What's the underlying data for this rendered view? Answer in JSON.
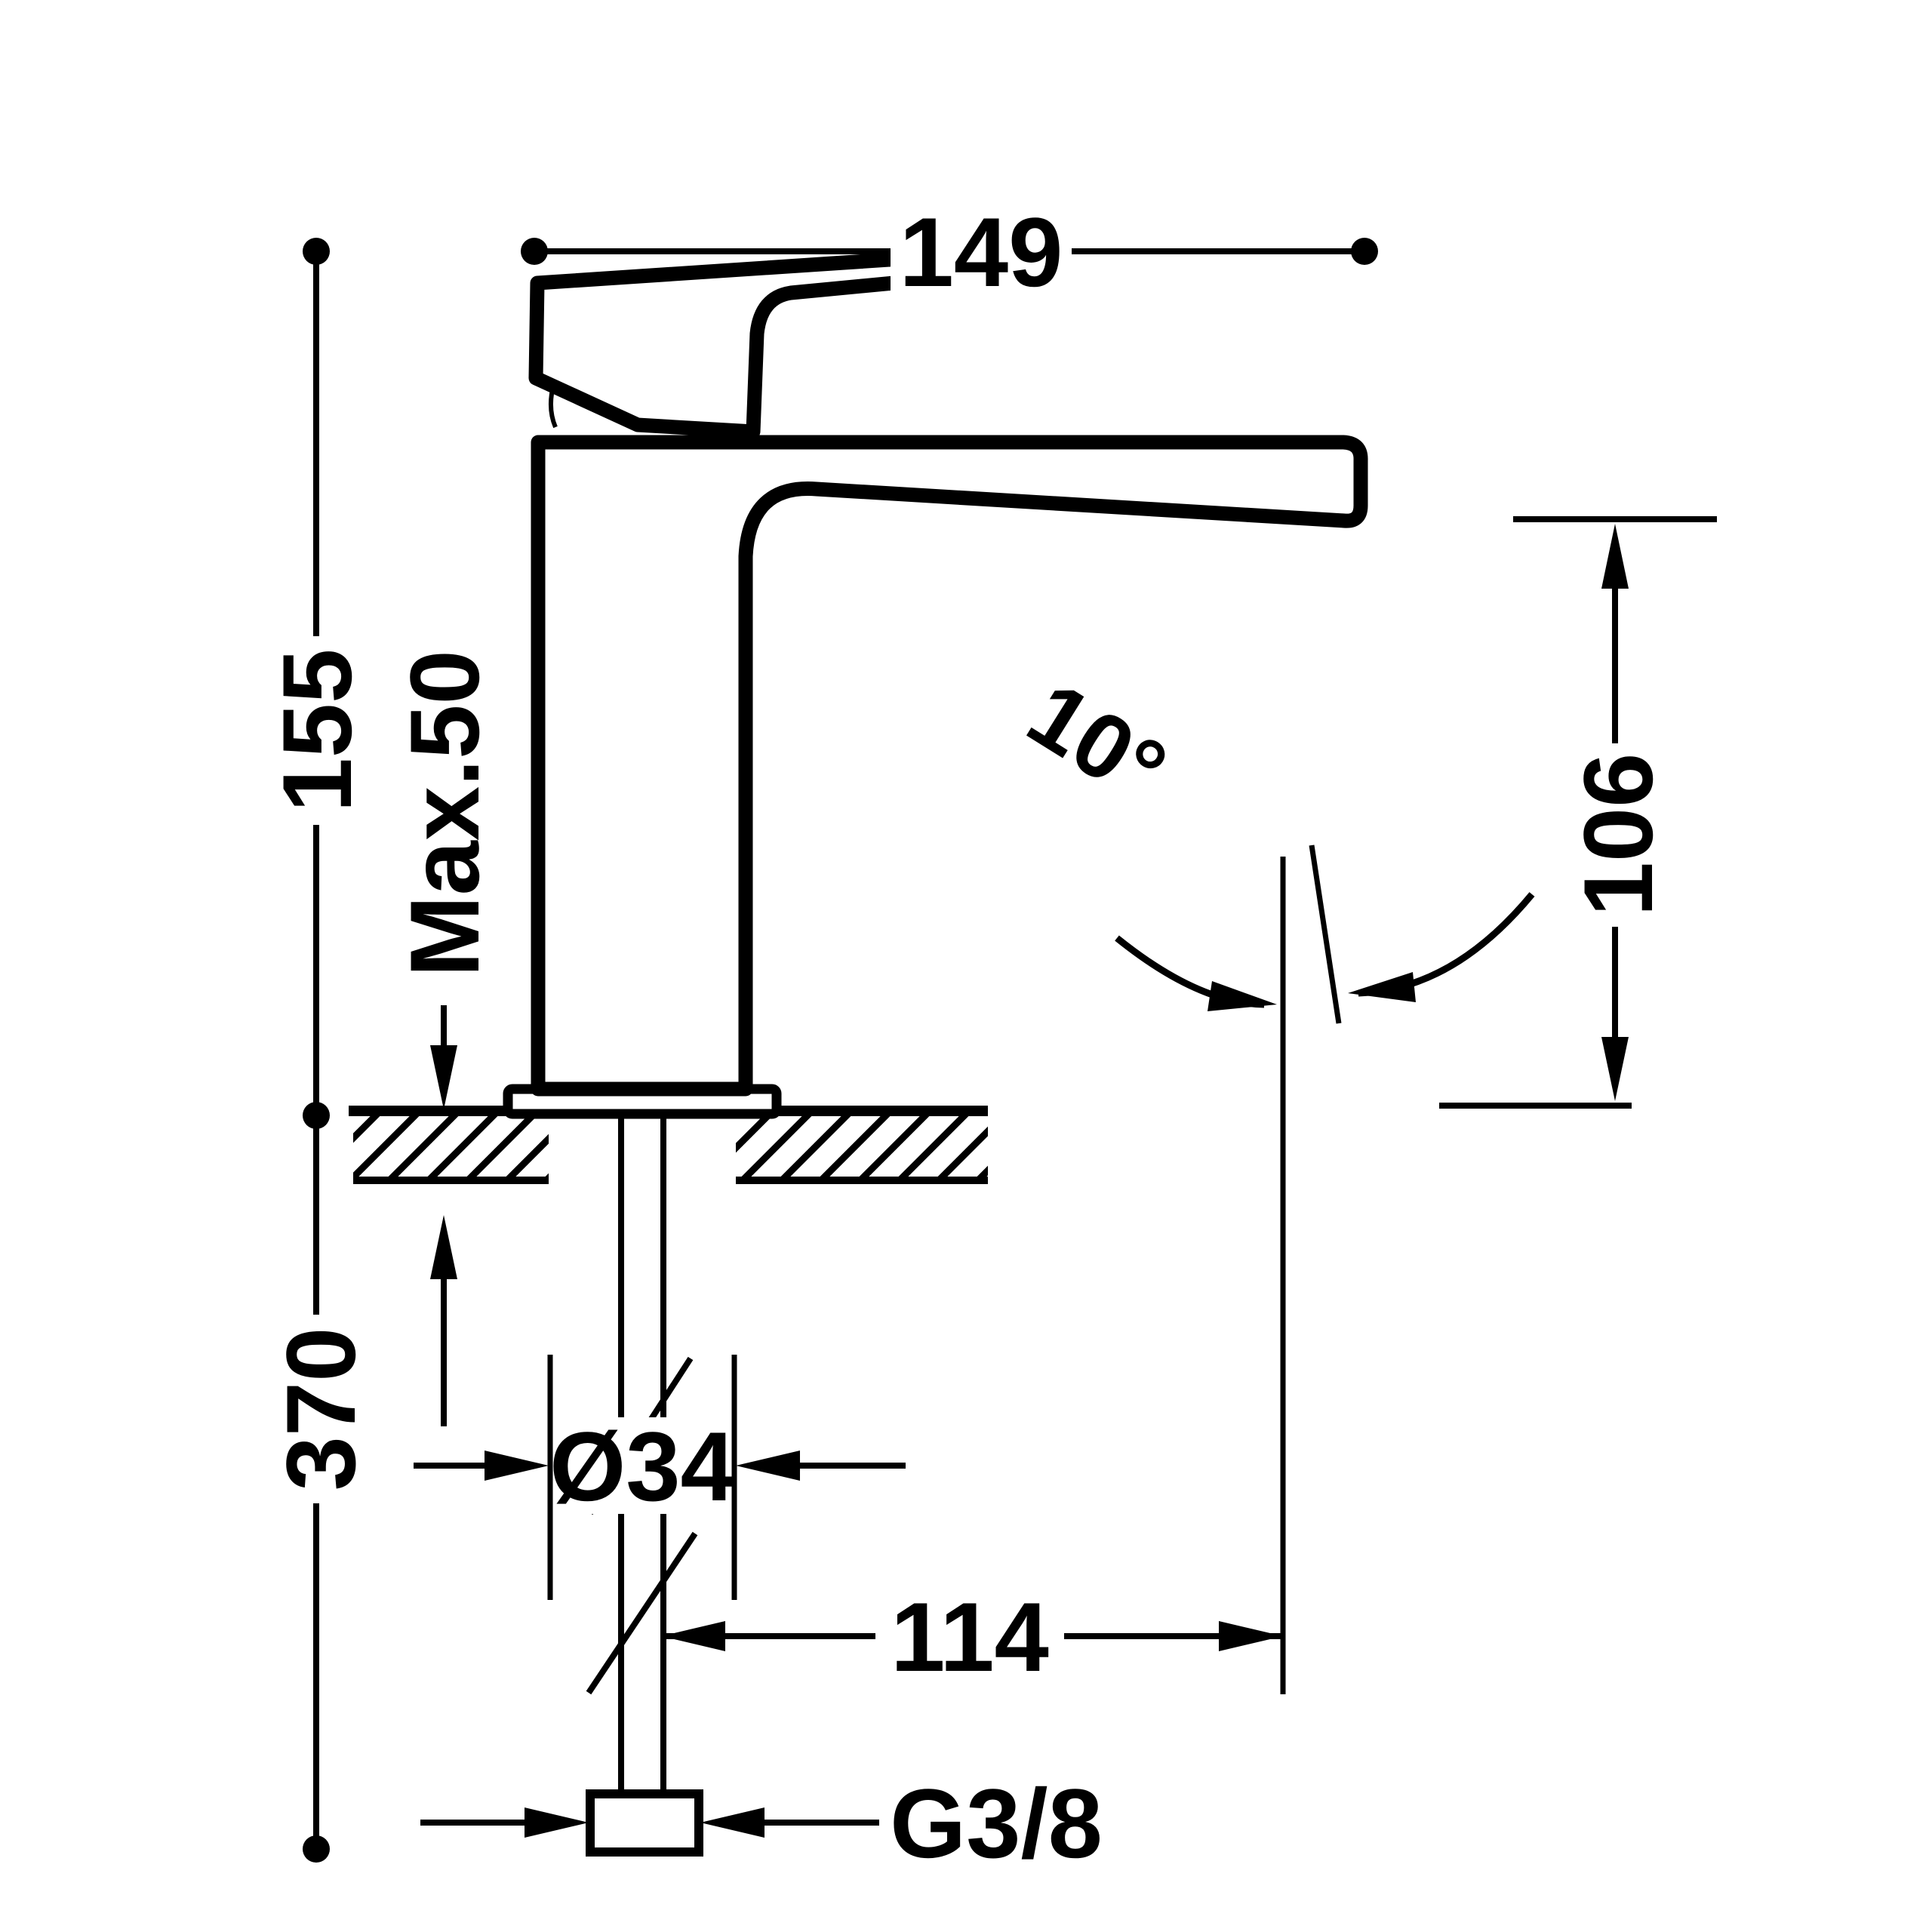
{
  "drawing": {
    "type": "technical-dimension-drawing",
    "subject": "single-lever basin mixer tap, side elevation",
    "units": "mm",
    "line_color": "#000000",
    "background_color": "#ffffff",
    "dimensions": {
      "overall_width": "149",
      "body_height": "155",
      "max_deck_thickness": "Max.50",
      "below_deck_length": "370",
      "shank_diameter": "Ø34",
      "spout_axis_offset": "114",
      "inlet_thread": "G3/8",
      "spout_angle": "10°",
      "outlet_height": "106"
    }
  }
}
